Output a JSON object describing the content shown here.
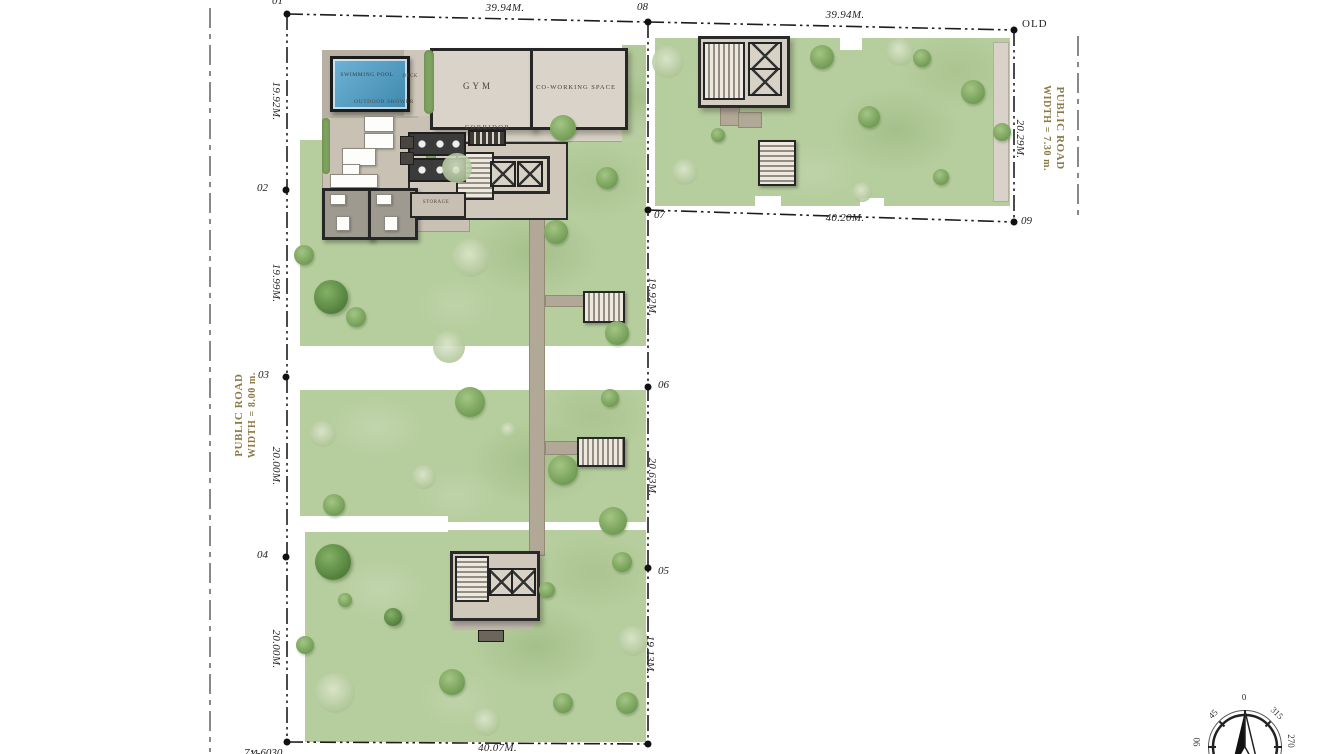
{
  "points": {
    "p01": "01",
    "p02": "02",
    "p03": "03",
    "p04": "04",
    "p05": "05",
    "p06": "06",
    "p07": "07",
    "p08": "08",
    "p09": "09",
    "old": "OLD",
    "survey_mark": "7ท-6030"
  },
  "dimensions": {
    "top_left_plot": "39.94M.",
    "top_right_plot": "39.94M.",
    "bottom_left_plot": "40.07M.",
    "bottom_right_plot": "40.20M.",
    "left_1": "19.92M.",
    "left_2": "19.99M.",
    "left_3": "20.00M.",
    "left_4": "20.00M.",
    "mid_1": "19.92M.",
    "mid_2": "20.63M.",
    "mid_3": "19.13M.",
    "right_1": "20.29M."
  },
  "roads": {
    "left_line1": "PUBLIC ROAD",
    "left_line2": "WIDTH = 8.00 m.",
    "right_line1": "PUBLIC ROAD",
    "right_line2": "WIDTH = 7.30 m."
  },
  "rooms": {
    "pool": "SWIMMING POOL",
    "deck": "DECK",
    "gym": "GYM",
    "coworking": "CO-WORKING SPACE",
    "shower": "OUTDOOR SHOWER",
    "corridor": "CORRIDOR",
    "storage": "STORAGE"
  },
  "compass": {
    "n": "0",
    "nw": "45",
    "ne": "315",
    "w": "90",
    "e": "270"
  },
  "colors": {
    "grass": "#b6cd9d",
    "tree": "#6f9a52",
    "pavement": "#cdc5b7",
    "pool_water": "#4e9cc6",
    "wall": "#272727",
    "dimension_text": "#262626",
    "road_text": "#8a7a45"
  }
}
